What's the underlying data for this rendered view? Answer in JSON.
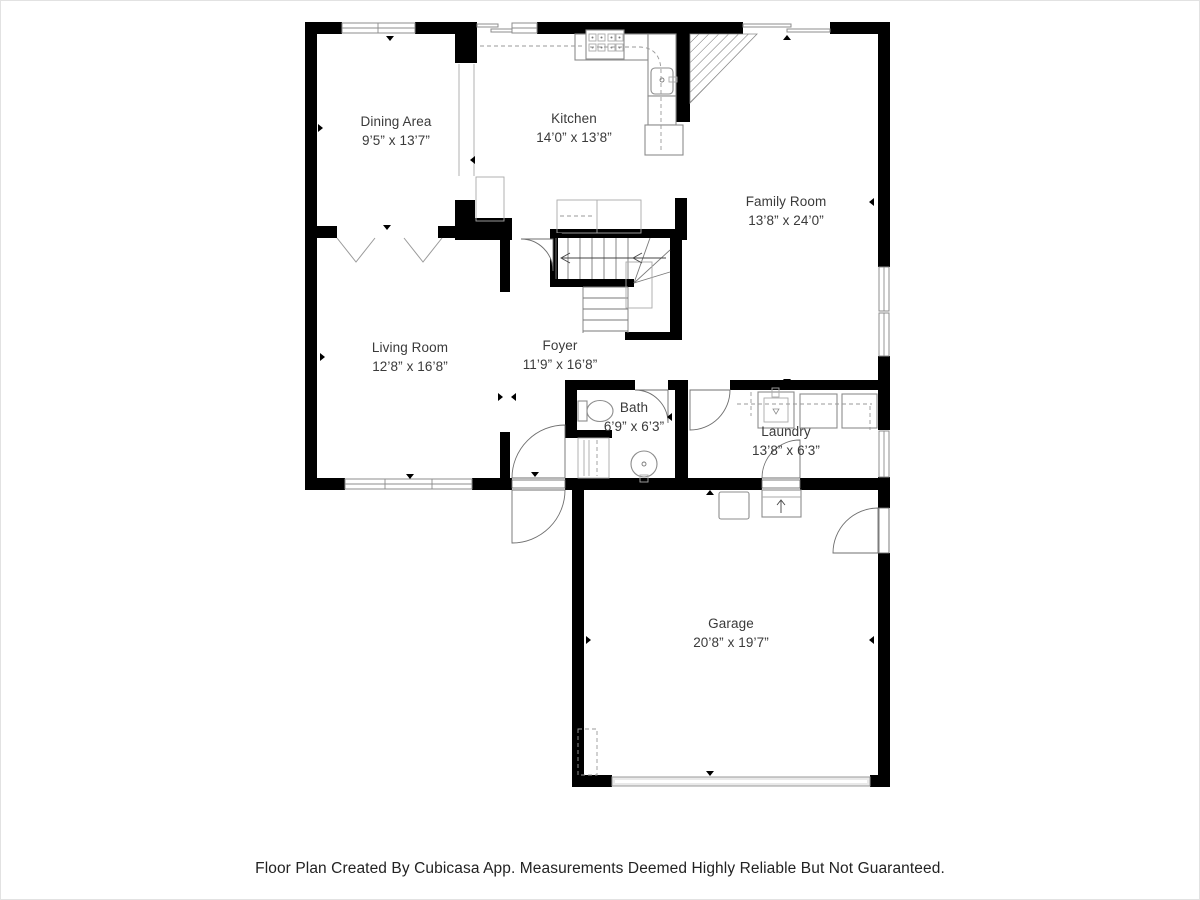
{
  "page": {
    "type": "floor-plan"
  },
  "rooms": {
    "dining": {
      "name": "Dining Area",
      "dims": "9’5” x 13’7”"
    },
    "kitchen": {
      "name": "Kitchen",
      "dims": "14’0” x 13’8”"
    },
    "family": {
      "name": "Family Room",
      "dims": "13’8” x 24’0”"
    },
    "living": {
      "name": "Living Room",
      "dims": "12’8” x 16’8”"
    },
    "foyer": {
      "name": "Foyer",
      "dims": "11’9” x 16’8”"
    },
    "bath": {
      "name": "Bath",
      "dims": "6’9” x 6’3”"
    },
    "laundry": {
      "name": "Laundry",
      "dims": "13’8” x 6’3”"
    },
    "garage": {
      "name": "Garage",
      "dims": "20’8” x 19’7”"
    }
  },
  "footer": {
    "text": "Floor Plan Created By Cubicasa App. Measurements Deemed Highly Reliable But Not Guaranteed."
  },
  "colors": {
    "wall": "#000000",
    "fixture_line": "#8c8c8c",
    "label_text": "#3a3a3a",
    "footer_text": "#222222",
    "background": "#ffffff"
  }
}
